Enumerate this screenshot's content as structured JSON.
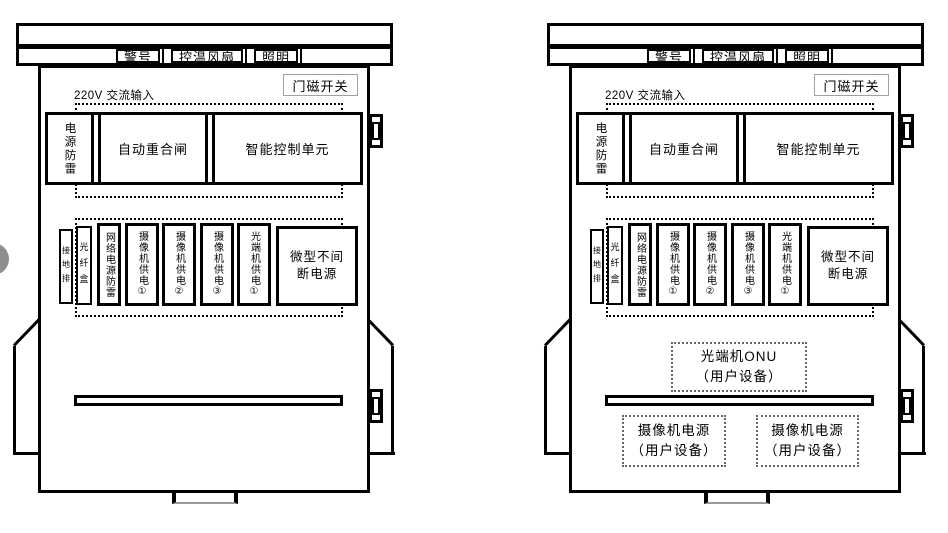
{
  "colors": {
    "ink": "#000000",
    "door_switch_border": "#a0a0a0",
    "edge_circle_fill": "#8e8e8e"
  },
  "cabinets": [
    {
      "roof_labels": [
        "警号",
        "控温风扇",
        "照明"
      ],
      "door_switch": "门磁开关",
      "ac_input": "220V 交流输入",
      "row1": [
        "电源防雷",
        "自动重合闸",
        "智能控制单元"
      ],
      "row2": [
        "接地排",
        "光纤盒",
        "网络电源防雷",
        "摄像机供电①",
        "摄像机供电②",
        "摄像机供电③",
        "光端机供电①",
        "微型不间断电源"
      ]
    },
    {
      "roof_labels": [
        "警号",
        "控温风扇",
        "照明"
      ],
      "door_switch": "门磁开关",
      "ac_input": "220V 交流输入",
      "row1": [
        "电源防雷",
        "自动重合闸",
        "智能控制单元"
      ],
      "row2": [
        "接地排",
        "光纤盒",
        "网络电源防雷",
        "摄像机供电①",
        "摄像机供电②",
        "摄像机供电③",
        "光端机供电①",
        "微型不间断电源"
      ],
      "user_equipment": {
        "onu": {
          "title": "光端机ONU",
          "subtitle": "（用户设备）"
        },
        "camera_left": {
          "title": "摄像机电源",
          "subtitle": "（用户设备）"
        },
        "camera_right": {
          "title": "摄像机电源",
          "subtitle": "（用户设备）"
        }
      }
    }
  ]
}
